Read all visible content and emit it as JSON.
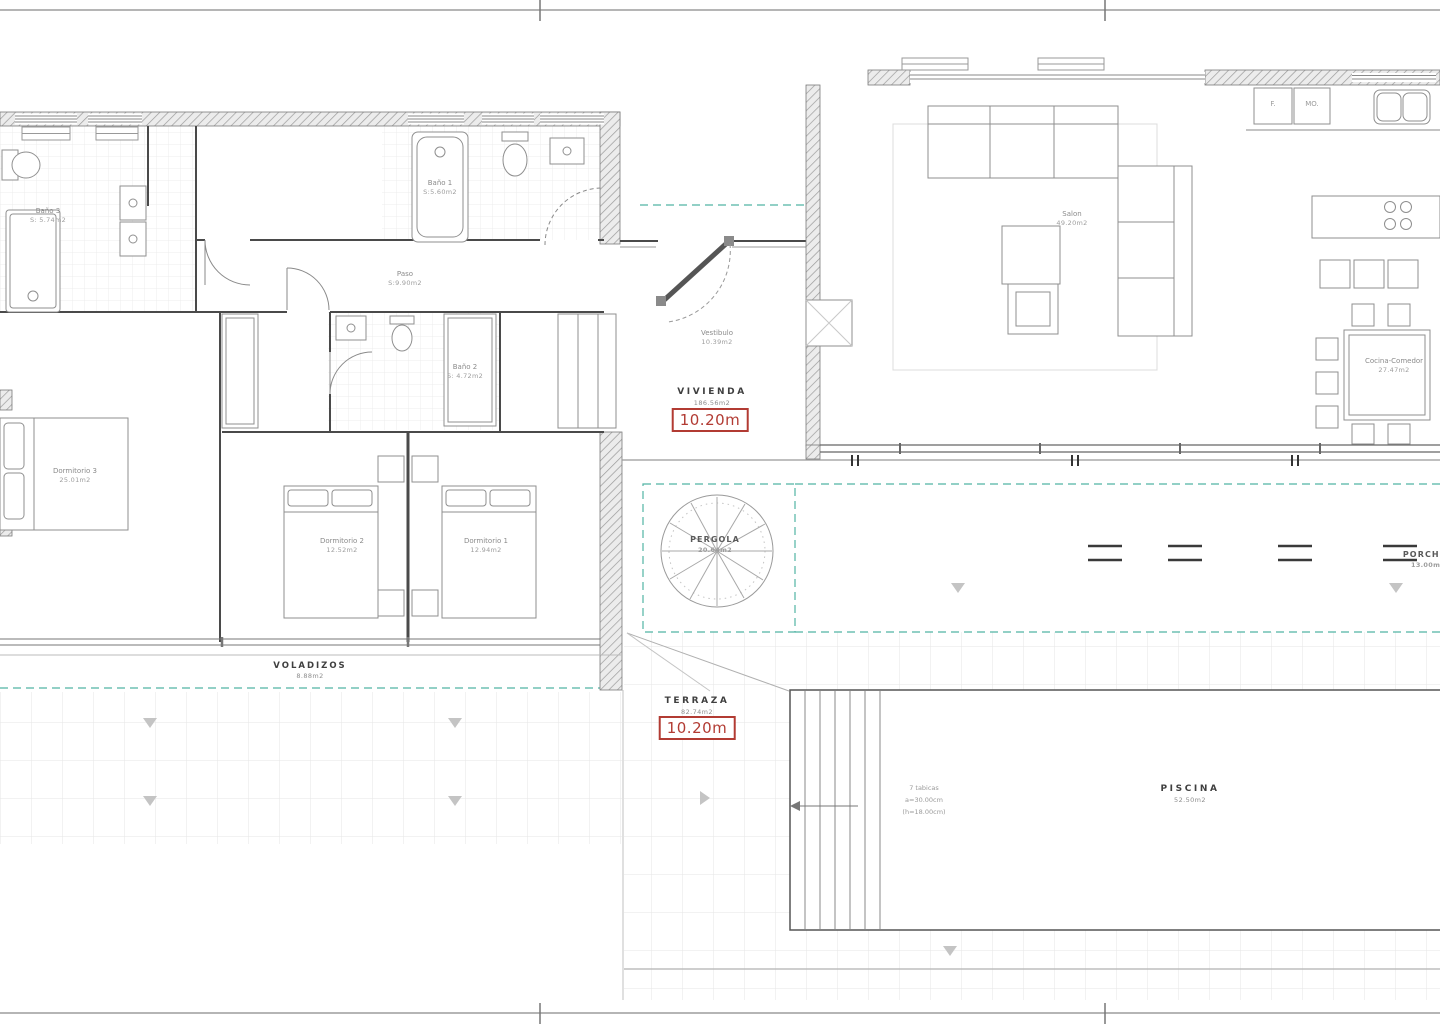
{
  "plan": {
    "rooms": {
      "bano3": {
        "name": "Baño 3",
        "area": "S: 5.74m2"
      },
      "bano1": {
        "name": "Baño 1",
        "area": "S:5.60m2"
      },
      "paso": {
        "name": "Paso",
        "area": "S:9.90m2"
      },
      "bano2": {
        "name": "Baño 2",
        "area": "S: 4.72m2"
      },
      "dormitorio3": {
        "name": "Dormitorio 3",
        "area": "25.01m2"
      },
      "dormitorio2": {
        "name": "Dormitorio 2",
        "area": "12.52m2"
      },
      "dormitorio1": {
        "name": "Dormitorio 1",
        "area": "12.94m2"
      },
      "vestibulo": {
        "name": "Vestibulo",
        "area": "10.39m2"
      },
      "salon": {
        "name": "Salon",
        "area": "49.20m2"
      },
      "cocina": {
        "name": "Cocina-Comedor",
        "area": "27.47m2"
      }
    },
    "zones": {
      "vivienda": {
        "name": "VIVIENDA",
        "area": "186.56m2",
        "height_tag": "10.20m"
      },
      "voladizos": {
        "name": "VOLADIZOS",
        "area": "8.88m2"
      },
      "pergola": {
        "name": "PERGOLA",
        "area": "20.64m2"
      },
      "porches": {
        "name": "PORCHES",
        "area": "13.00m2"
      },
      "terraza": {
        "name": "TERRAZA",
        "area": "82.74m2",
        "height_tag": "10.20m"
      },
      "piscina": {
        "name": "PISCINA",
        "area": "52.50m2"
      }
    },
    "annotations": {
      "pool_steps_line1": "7 tabicas",
      "pool_steps_line2": "a=30.00cm",
      "pool_steps_line3": "(h=18.00cm)"
    },
    "kitchen": {
      "fridge_label": "F.",
      "oven_label": "MO."
    },
    "colors": {
      "tag_red": "#b23b33",
      "landscape_teal": "#52b3a4",
      "wall_gray": "#9b9b9b"
    }
  }
}
